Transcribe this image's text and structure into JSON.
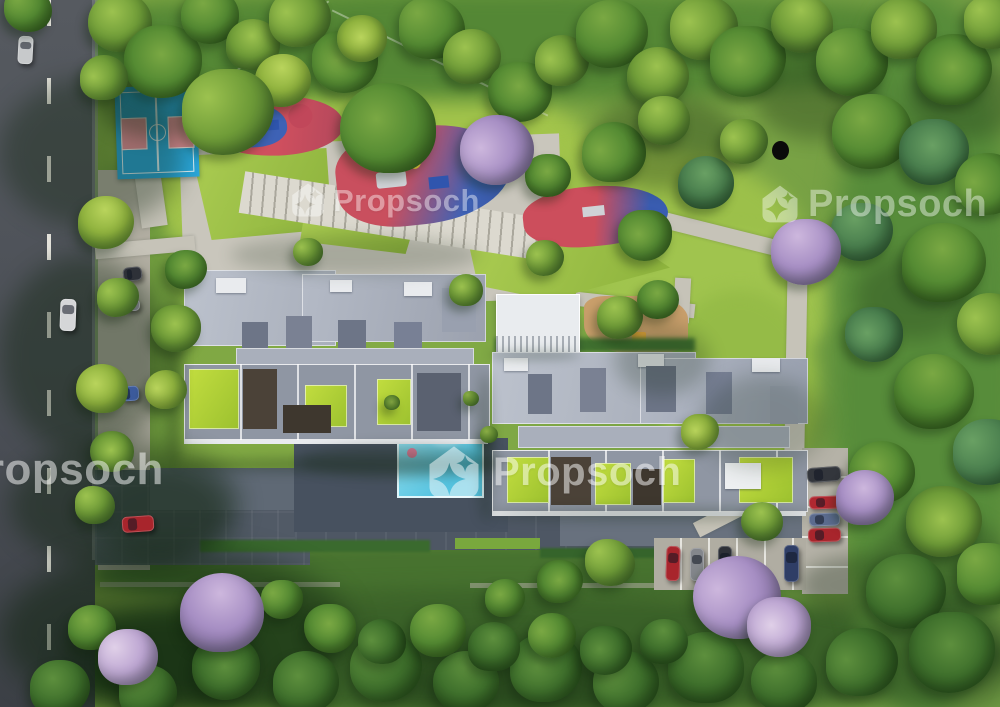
{
  "meta": {
    "description": "Photorealistic aerial 3D render of a residential apartment complex site plan with amenities, roads, parked cars and landscaping"
  },
  "watermark": {
    "brand": "Propsoch",
    "partial_text_left_edge": "opsoch",
    "color": "#ffffff"
  },
  "icons": {
    "logo": "propsoch-home-sparkle-logo"
  },
  "colors": {
    "grass_base": "#7ba441",
    "lawn_bright": "#a5c84e",
    "terrace_lime": "#b9d637",
    "road": "#4a4e55",
    "pavement": "#c6c3b8",
    "driveway_dark": "#515a66",
    "roof_light": "#b8bec9",
    "roof_dark": "#6d7587",
    "clubhouse_white": "#e9ecef",
    "pool_blue": "#6ed0e8",
    "deck_wood": "#b5895c",
    "court_blue": "#2aa7db",
    "court_key_pink": "#ef94a0",
    "playground_red": "#cf4f5e",
    "playground_blue": "#3e62b5",
    "flowering_purple": "#a78fc4",
    "car_red": "#a8252c",
    "car_blue": "#3d5c9e",
    "black_dot": "#0a0a0a"
  },
  "scene": {
    "tree_palettes": {
      "g1": [
        "#b9d45c",
        "#8fb23e",
        "#5d8730"
      ],
      "g2": [
        "#9cc24f",
        "#6f9c38",
        "#47702b"
      ],
      "g3": [
        "#7aa843",
        "#558b33",
        "#35601f"
      ],
      "g4": [
        "#5d8f3d",
        "#3f702c",
        "#274d1b"
      ],
      "g5": [
        "#69a063",
        "#4a7f4e",
        "#2f5a35"
      ],
      "p1": [
        "#cdb7dd",
        "#a78fc4",
        "#7d6a99"
      ],
      "p2": [
        "#e0d0e8",
        "#bda6d2",
        "#8f7aa8"
      ]
    },
    "trees": [
      [
        28,
        10,
        48,
        "g3"
      ],
      [
        120,
        22,
        64,
        "g2"
      ],
      [
        163,
        62,
        78,
        "g3"
      ],
      [
        104,
        78,
        48,
        "g2"
      ],
      [
        210,
        16,
        58,
        "g3"
      ],
      [
        253,
        44,
        54,
        "g2"
      ],
      [
        300,
        18,
        62,
        "g2"
      ],
      [
        345,
        62,
        66,
        "g3"
      ],
      [
        283,
        80,
        56,
        "g1"
      ],
      [
        228,
        112,
        92,
        "g2"
      ],
      [
        388,
        128,
        96,
        "g3"
      ],
      [
        362,
        38,
        50,
        "g1"
      ],
      [
        432,
        28,
        66,
        "g3"
      ],
      [
        472,
        56,
        58,
        "g2"
      ],
      [
        520,
        92,
        64,
        "g3"
      ],
      [
        562,
        60,
        54,
        "g2"
      ],
      [
        612,
        34,
        72,
        "g3"
      ],
      [
        658,
        76,
        62,
        "g2"
      ],
      [
        704,
        28,
        68,
        "g2"
      ],
      [
        748,
        62,
        76,
        "g3"
      ],
      [
        802,
        24,
        62,
        "g2"
      ],
      [
        852,
        62,
        72,
        "g3"
      ],
      [
        904,
        28,
        66,
        "g2"
      ],
      [
        954,
        70,
        76,
        "g3"
      ],
      [
        992,
        22,
        56,
        "g2"
      ],
      [
        872,
        132,
        80,
        "g3"
      ],
      [
        934,
        152,
        70,
        "g5"
      ],
      [
        988,
        184,
        66,
        "g3"
      ],
      [
        862,
        232,
        62,
        "g5"
      ],
      [
        944,
        262,
        84,
        "g3"
      ],
      [
        990,
        324,
        66,
        "g2"
      ],
      [
        874,
        334,
        58,
        "g5"
      ],
      [
        934,
        392,
        80,
        "g3"
      ],
      [
        988,
        452,
        70,
        "g5"
      ],
      [
        882,
        472,
        66,
        "g3"
      ],
      [
        944,
        522,
        76,
        "g2"
      ],
      [
        990,
        574,
        66,
        "g3"
      ],
      [
        906,
        592,
        80,
        "g4"
      ],
      [
        952,
        652,
        86,
        "g4"
      ],
      [
        862,
        662,
        72,
        "g4"
      ],
      [
        784,
        682,
        66,
        "g4"
      ],
      [
        706,
        668,
        76,
        "g4"
      ],
      [
        626,
        682,
        66,
        "g4"
      ],
      [
        546,
        668,
        72,
        "g4"
      ],
      [
        466,
        682,
        66,
        "g4"
      ],
      [
        386,
        668,
        72,
        "g4"
      ],
      [
        306,
        682,
        66,
        "g4"
      ],
      [
        226,
        668,
        68,
        "g4"
      ],
      [
        148,
        692,
        58,
        "g4"
      ],
      [
        60,
        688,
        60,
        "g4"
      ],
      [
        330,
        628,
        52,
        "g3"
      ],
      [
        382,
        642,
        48,
        "g4"
      ],
      [
        438,
        630,
        56,
        "g3"
      ],
      [
        494,
        646,
        52,
        "g4"
      ],
      [
        552,
        636,
        48,
        "g3"
      ],
      [
        606,
        650,
        52,
        "g4"
      ],
      [
        664,
        642,
        48,
        "g4"
      ],
      [
        282,
        600,
        42,
        "g3"
      ],
      [
        505,
        598,
        40,
        "g3"
      ],
      [
        560,
        582,
        46,
        "g3"
      ],
      [
        610,
        562,
        50,
        "g2"
      ],
      [
        502,
        142,
        56,
        "g2"
      ],
      [
        548,
        176,
        46,
        "g3"
      ],
      [
        614,
        152,
        64,
        "g3"
      ],
      [
        664,
        120,
        52,
        "g2"
      ],
      [
        706,
        182,
        56,
        "g5"
      ],
      [
        744,
        142,
        48,
        "g2"
      ],
      [
        645,
        235,
        54,
        "g3"
      ],
      [
        106,
        222,
        56,
        "g1"
      ],
      [
        118,
        298,
        42,
        "g2"
      ],
      [
        102,
        388,
        52,
        "g1"
      ],
      [
        112,
        452,
        44,
        "g2"
      ],
      [
        95,
        505,
        40,
        "g2"
      ],
      [
        92,
        628,
        48,
        "g3"
      ],
      [
        176,
        328,
        50,
        "g2"
      ],
      [
        166,
        390,
        42,
        "g1"
      ],
      [
        620,
        318,
        46,
        "g2"
      ],
      [
        658,
        300,
        42,
        "g3"
      ],
      [
        545,
        258,
        38,
        "g2"
      ],
      [
        700,
        432,
        38,
        "g1"
      ],
      [
        762,
        522,
        42,
        "g2"
      ],
      [
        308,
        252,
        30,
        "g2"
      ],
      [
        466,
        290,
        34,
        "g2"
      ],
      [
        392,
        403,
        16,
        "g2"
      ],
      [
        471,
        399,
        16,
        "g2"
      ],
      [
        489,
        434,
        18,
        "g2"
      ],
      [
        186,
        270,
        42,
        "g3"
      ],
      [
        497,
        150,
        74,
        "p1"
      ],
      [
        806,
        252,
        70,
        "p1"
      ],
      [
        865,
        497,
        58,
        "p1"
      ],
      [
        737,
        597,
        88,
        "p1"
      ],
      [
        779,
        627,
        64,
        "p2"
      ],
      [
        222,
        612,
        84,
        "p1"
      ],
      [
        128,
        657,
        60,
        "p2"
      ]
    ],
    "cars": [
      [
        18,
        36,
        15,
        28,
        3,
        "#c7c9cb"
      ],
      [
        60,
        299,
        16,
        32,
        2,
        "#d5d6d8"
      ],
      [
        123,
        267,
        19,
        14,
        -6,
        "#2e3138"
      ],
      [
        123,
        299,
        17,
        12,
        0,
        "#74777c"
      ],
      [
        121,
        386,
        18,
        15,
        -4,
        "#3d5c9e"
      ],
      [
        122,
        516,
        32,
        16,
        -4,
        "#a8252c"
      ],
      [
        666,
        546,
        14,
        35,
        2,
        "#a8252c"
      ],
      [
        690,
        548,
        14,
        33,
        0,
        "#84878c"
      ],
      [
        718,
        546,
        14,
        33,
        0,
        "#2e3138"
      ],
      [
        784,
        545,
        15,
        37,
        0,
        "#2f3e66"
      ],
      [
        807,
        467,
        34,
        15,
        -4,
        "#33363c"
      ],
      [
        809,
        496,
        33,
        13,
        -2,
        "#b02830"
      ],
      [
        809,
        513,
        31,
        13,
        -2,
        "#5b6b8e"
      ],
      [
        808,
        528,
        33,
        14,
        -2,
        "#a8252c"
      ]
    ],
    "shadows": [
      [
        0,
        78,
        185,
        150,
        0.35,
        12
      ],
      [
        0,
        255,
        170,
        200,
        0.4,
        12
      ],
      [
        10,
        440,
        230,
        130,
        0.42,
        12
      ],
      [
        0,
        548,
        350,
        170,
        0.5,
        14
      ],
      [
        95,
        470,
        130,
        90,
        0.3,
        10
      ],
      [
        98,
        70,
        115,
        68,
        0.35,
        9
      ],
      [
        166,
        292,
        16,
        178,
        0.3,
        6
      ],
      [
        176,
        458,
        330,
        14,
        0.3,
        6
      ],
      [
        478,
        372,
        14,
        150,
        0.28,
        6
      ],
      [
        486,
        508,
        330,
        12,
        0.28,
        6
      ],
      [
        488,
        350,
        92,
        10,
        0.25,
        5
      ],
      [
        615,
        325,
        95,
        70,
        0.22,
        9
      ],
      [
        700,
        375,
        125,
        95,
        0.2,
        10
      ],
      [
        855,
        255,
        115,
        85,
        0.25,
        10
      ],
      [
        875,
        515,
        135,
        105,
        0.28,
        10
      ],
      [
        590,
        95,
        150,
        95,
        0.3,
        10
      ],
      [
        755,
        55,
        125,
        85,
        0.3,
        10
      ],
      [
        905,
        60,
        120,
        80,
        0.28,
        10
      ],
      [
        860,
        600,
        160,
        110,
        0.35,
        12
      ],
      [
        390,
        640,
        260,
        80,
        0.35,
        12
      ],
      [
        60,
        615,
        200,
        100,
        0.4,
        12
      ],
      [
        298,
        444,
        205,
        34,
        0.25,
        6
      ],
      [
        230,
        235,
        250,
        40,
        0.18,
        8
      ],
      [
        800,
        555,
        120,
        60,
        0.3,
        9
      ]
    ],
    "watermarks": [
      [
        290,
        182,
        36,
        31,
        0.42
      ],
      [
        760,
        184,
        40,
        38,
        0.42
      ],
      [
        426,
        444,
        56,
        40,
        0.5
      ],
      [
        -96,
        448,
        44,
        44,
        0.5
      ]
    ],
    "black_dot": {
      "x": 772,
      "y": 141,
      "d": 17
    }
  }
}
